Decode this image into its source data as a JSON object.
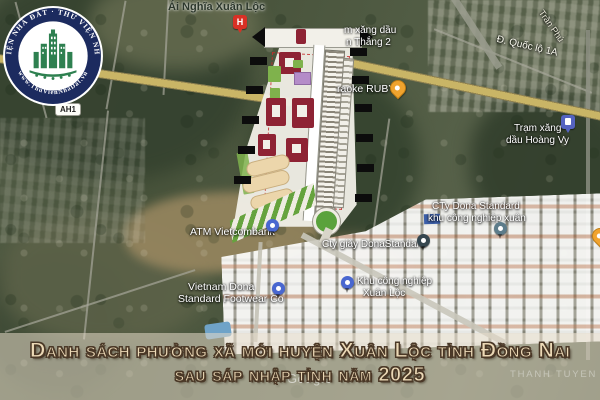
{
  "logo": {
    "ring_text_top": "THƯ VIỆN NHÀ ĐẤT · THƯ VIỆN NHÀ ĐẤT",
    "ring_text_bottom": "www.ThuVienNhaDat.vn",
    "ring_color": "#1c2b5f",
    "emblem_color": "#2e8050"
  },
  "map": {
    "route_badge": "AH1",
    "labels": {
      "village": "Ái Nghĩa Xuân Lộc",
      "gas_station_partial": [
        "m xăng dầu",
        "n Thắng 2"
      ],
      "karaoke_partial": "raoke RUBY",
      "street_tran_phu": "Trần Phú",
      "highway_ql1a": "Đ. Quốc lộ 1A",
      "gas_hoang_vy": [
        "Trạm xăng",
        "dầu Hoàng Vy"
      ],
      "atm_vietcombank": "ATM Vietcombank",
      "shoe_factory": "Cty giày DonaStandard",
      "industrial_park": [
        "Khu công nghiệp",
        "Xuân Lộc"
      ],
      "footwear_co": [
        "Vietnam Dona",
        "Standard Footwear Co"
      ],
      "dona_standard": [
        "CTy Dona Standard",
        "khu công nghiệp xuân"
      ],
      "faint_area": "THANH TUYEN"
    },
    "markers": {
      "hotel_glyph": "H"
    },
    "marker_colors": {
      "hotel": "#d93025",
      "karaoke": "#f0a32e",
      "gas_hoang_vy": "#5563c1",
      "atm": "#4967d0",
      "industrial_park": "#4967d0",
      "footwear": "#4967d0",
      "shoe_factory": "#36474f",
      "dona_standard": "#5d7c8a"
    }
  },
  "banner": {
    "line1": "Danh sách phường xã mới huyện Xuân Lộc tỉnh Đồng Nai",
    "line2": "sau sáp nhập tỉnh năm 2025",
    "text_color": "#ecd9b6",
    "outline_color": "#4a3827",
    "band_color": "rgba(229,219,201,0.55)"
  },
  "watermark": "Google"
}
